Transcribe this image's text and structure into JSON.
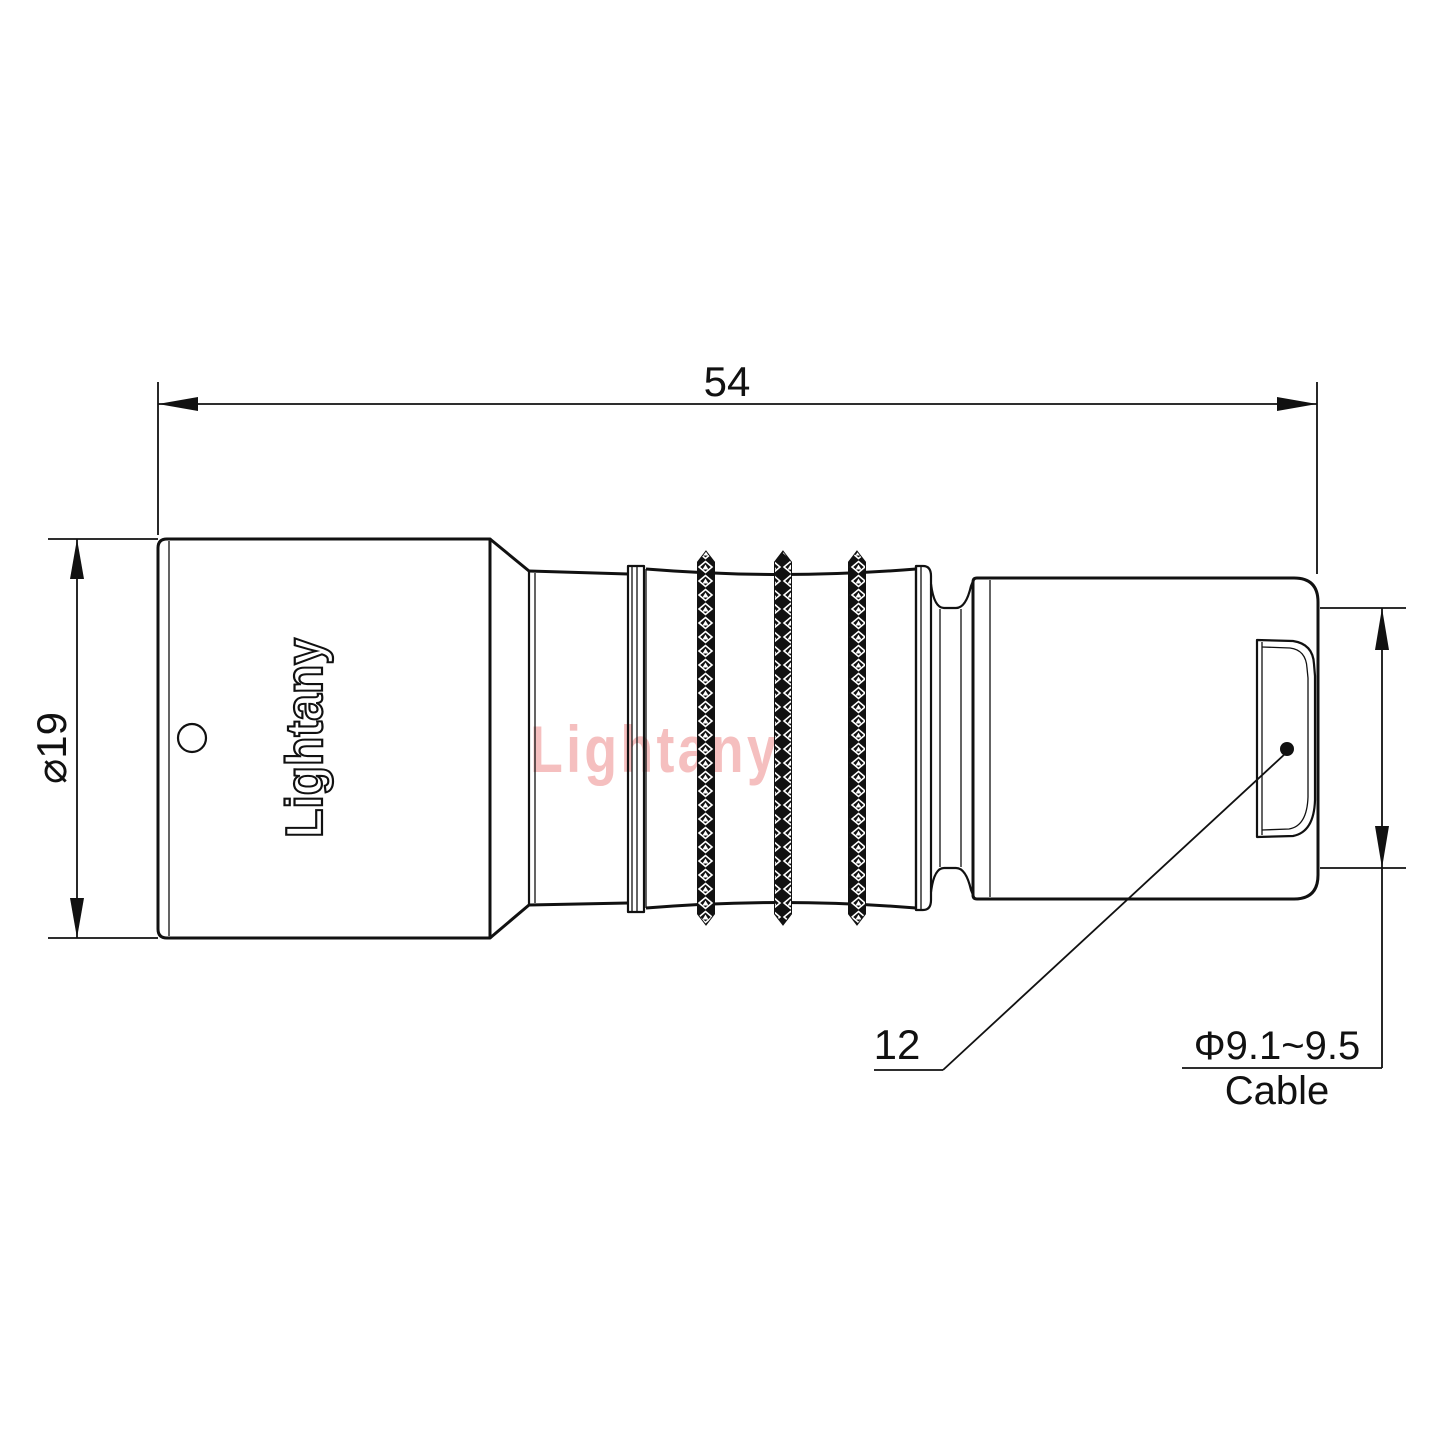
{
  "drawing": {
    "watermark": "Lightany",
    "engraving": "Lightany",
    "dimensions": {
      "overall_length": "54",
      "body_diameter": "⌀19",
      "boot_ref": "12",
      "cable_diameter": "Φ9.1~9.5",
      "cable_label": "Cable"
    },
    "colors": {
      "line": "#111111",
      "watermark": "#f5bfbf",
      "background": "#ffffff"
    }
  }
}
